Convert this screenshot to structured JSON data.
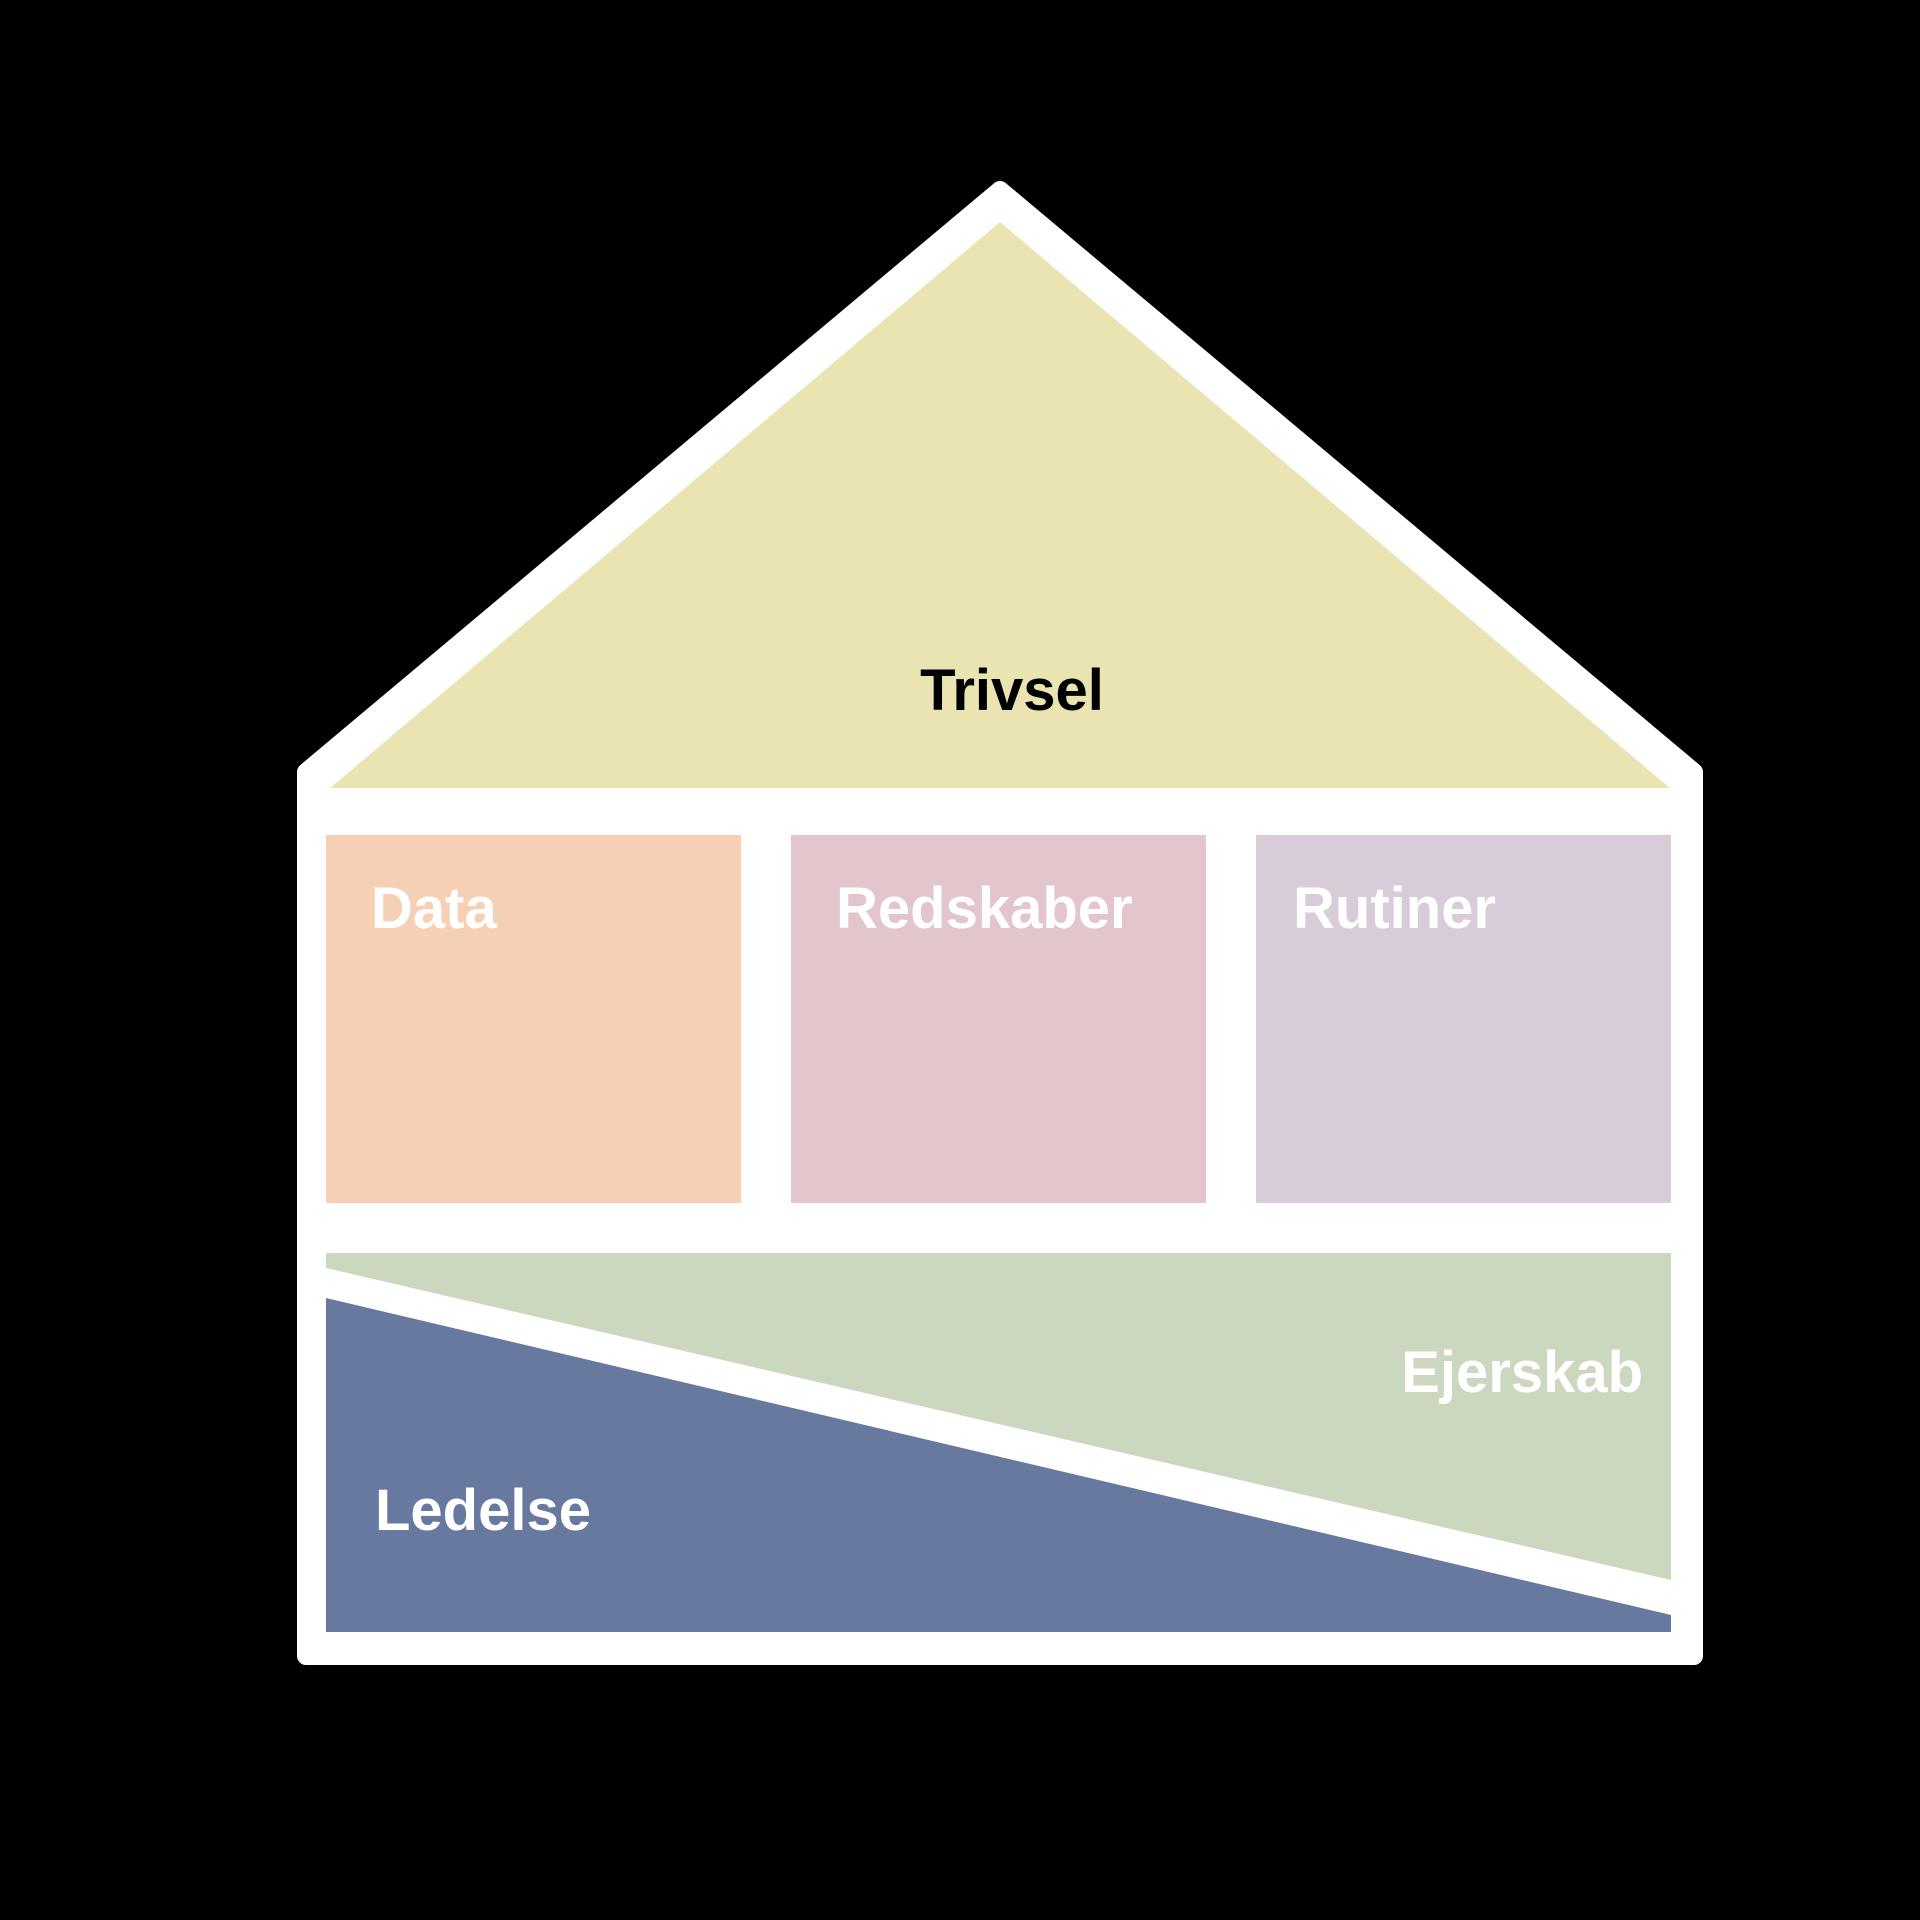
{
  "house": {
    "roof_label": "Trivsel",
    "pillars": [
      {
        "label": "Data"
      },
      {
        "label": "Redskaber"
      },
      {
        "label": "Rutiner"
      }
    ],
    "foundation_upper_label": "Ejerskab",
    "foundation_lower_label": "Ledelse"
  },
  "colors": {
    "background": "#000000",
    "border": "#ffffff",
    "roof": "#e9e4b2",
    "data": "#f6d0b5",
    "redskaber": "#e3c5cc",
    "rutiner": "#d8ccd8",
    "ejerskab": "#cbd7bf",
    "ledelse": "#68799f",
    "roof_label_text": "#000000",
    "label_text": "#ffffff"
  }
}
